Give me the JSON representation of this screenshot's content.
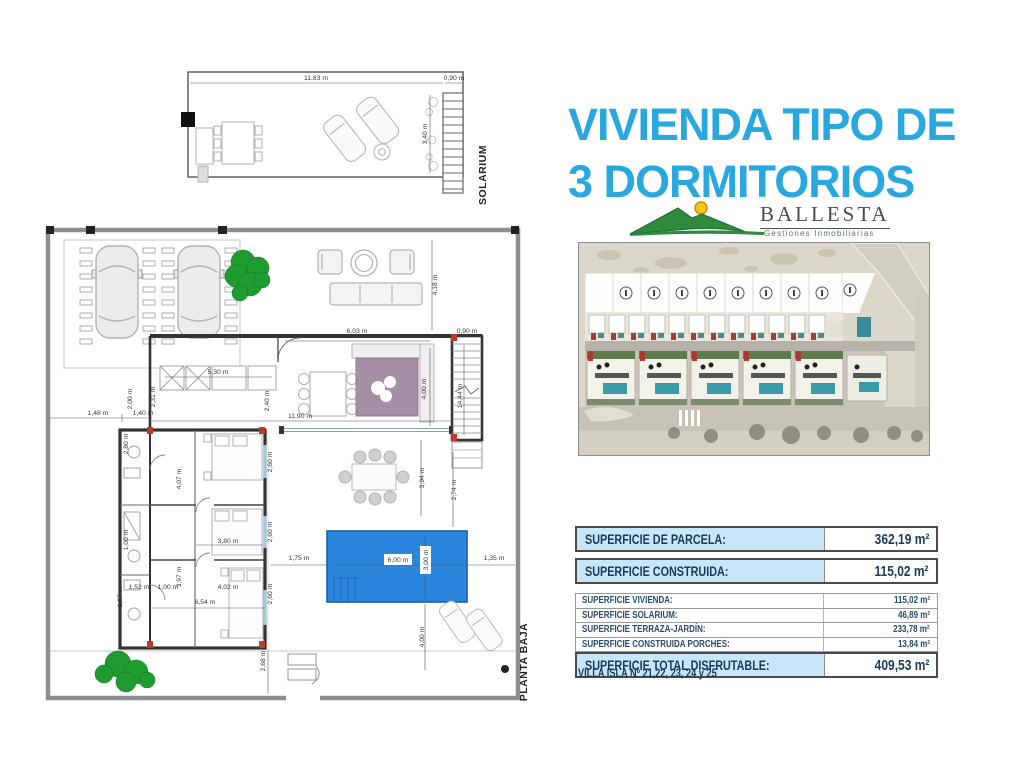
{
  "title": {
    "line1": "VIVIENDA TIPO DE",
    "line2": "3 DORMITORIOS"
  },
  "logo": {
    "name": "BALLESTA",
    "tagline": "Gestiones Inmobiliarias"
  },
  "plans": {
    "solarium_label": "SOLARIUM",
    "ground_floor_label": "PLANTA BAJA",
    "dimensions": [
      {
        "t": "11,83 m",
        "x": 316,
        "y": 80
      },
      {
        "t": "0,90 m",
        "x": 454,
        "y": 80
      },
      {
        "t": "3,40 m",
        "x": 427,
        "y": 134,
        "r": -90
      },
      {
        "t": "4,18 m",
        "x": 437,
        "y": 285,
        "r": -90
      },
      {
        "t": "6,03 m",
        "x": 357,
        "y": 333
      },
      {
        "t": "0,90 m",
        "x": 467,
        "y": 333
      },
      {
        "t": "5,30 m",
        "x": 218,
        "y": 374
      },
      {
        "t": "2,40 m",
        "x": 269,
        "y": 401,
        "r": -90
      },
      {
        "t": "11,90 m",
        "x": 300,
        "y": 418
      },
      {
        "t": "4,00 m",
        "x": 426,
        "y": 389,
        "r": -90
      },
      {
        "t": "14,44 m",
        "x": 462,
        "y": 396,
        "r": -90
      },
      {
        "t": "1,48 m",
        "x": 98,
        "y": 415
      },
      {
        "t": "1,40 m",
        "x": 143,
        "y": 415
      },
      {
        "t": "2,00 m",
        "x": 132,
        "y": 399,
        "r": -90
      },
      {
        "t": "2,31 m",
        "x": 155,
        "y": 397,
        "r": -90
      },
      {
        "t": "2,80 m",
        "x": 128,
        "y": 444,
        "r": -90
      },
      {
        "t": "4,07 m",
        "x": 181,
        "y": 479,
        "r": -90
      },
      {
        "t": "2,60 m",
        "x": 272,
        "y": 462,
        "r": -90
      },
      {
        "t": "2,60 m",
        "x": 272,
        "y": 532,
        "r": -90
      },
      {
        "t": "3,80 m",
        "x": 228,
        "y": 543
      },
      {
        "t": "1,00 m",
        "x": 128,
        "y": 540,
        "r": -90
      },
      {
        "t": "3,97 m",
        "x": 181,
        "y": 577,
        "r": -90
      },
      {
        "t": "1,07 m",
        "x": 122,
        "y": 597,
        "r": -90
      },
      {
        "t": "1,52 m",
        "x": 139,
        "y": 589
      },
      {
        "t": "1,00 m",
        "x": 168,
        "y": 589
      },
      {
        "t": "4,02 m",
        "x": 228,
        "y": 589
      },
      {
        "t": "6,54 m",
        "x": 205,
        "y": 604
      },
      {
        "t": "2,60 m",
        "x": 272,
        "y": 594,
        "r": -90
      },
      {
        "t": "3,94 m",
        "x": 424,
        "y": 478,
        "r": -90
      },
      {
        "t": "2,74 m",
        "x": 456,
        "y": 490,
        "r": -90
      },
      {
        "t": "1,75 m",
        "x": 299,
        "y": 560
      },
      {
        "t": "6,00 m",
        "x": 398,
        "y": 562,
        "box": true
      },
      {
        "t": "3,00 m",
        "x": 428,
        "y": 560,
        "r": -90,
        "box": true
      },
      {
        "t": "1,35 m",
        "x": 494,
        "y": 560
      },
      {
        "t": "4,00 m",
        "x": 424,
        "y": 637,
        "r": -90
      },
      {
        "t": "2,68 m",
        "x": 265,
        "y": 661,
        "r": -90
      }
    ]
  },
  "surface_table": {
    "rows": [
      {
        "label": "SUPERFICIE DE PARCELA:",
        "value": "362,19 m²",
        "style": "major",
        "gap_after": 6
      },
      {
        "label": "SUPERFICIE CONSTRUIDA:",
        "value": "115,02 m²",
        "style": "major",
        "gap_after": 10
      },
      {
        "label": "SUPERFICIE VIVIENDA:",
        "value": "115,02 m²",
        "style": "minor"
      },
      {
        "label": "SUPERFICIE SOLARIUM:",
        "value": "46,89 m²",
        "style": "minor"
      },
      {
        "label": "SUPERFICIE TERRAZA-JARDÍN:",
        "value": "233,78 m²",
        "style": "minor"
      },
      {
        "label": "SUPERFICIE CONSTRUIDA PORCHES:",
        "value": "13,84 m²",
        "style": "minor"
      },
      {
        "label": "SUPERFICIE TOTAL DISFRUTABLE:",
        "value": "409,53 m²",
        "style": "major"
      }
    ]
  },
  "villa_note": "VILLA ISLA Nº 21,22, 23, 24 y 25"
}
